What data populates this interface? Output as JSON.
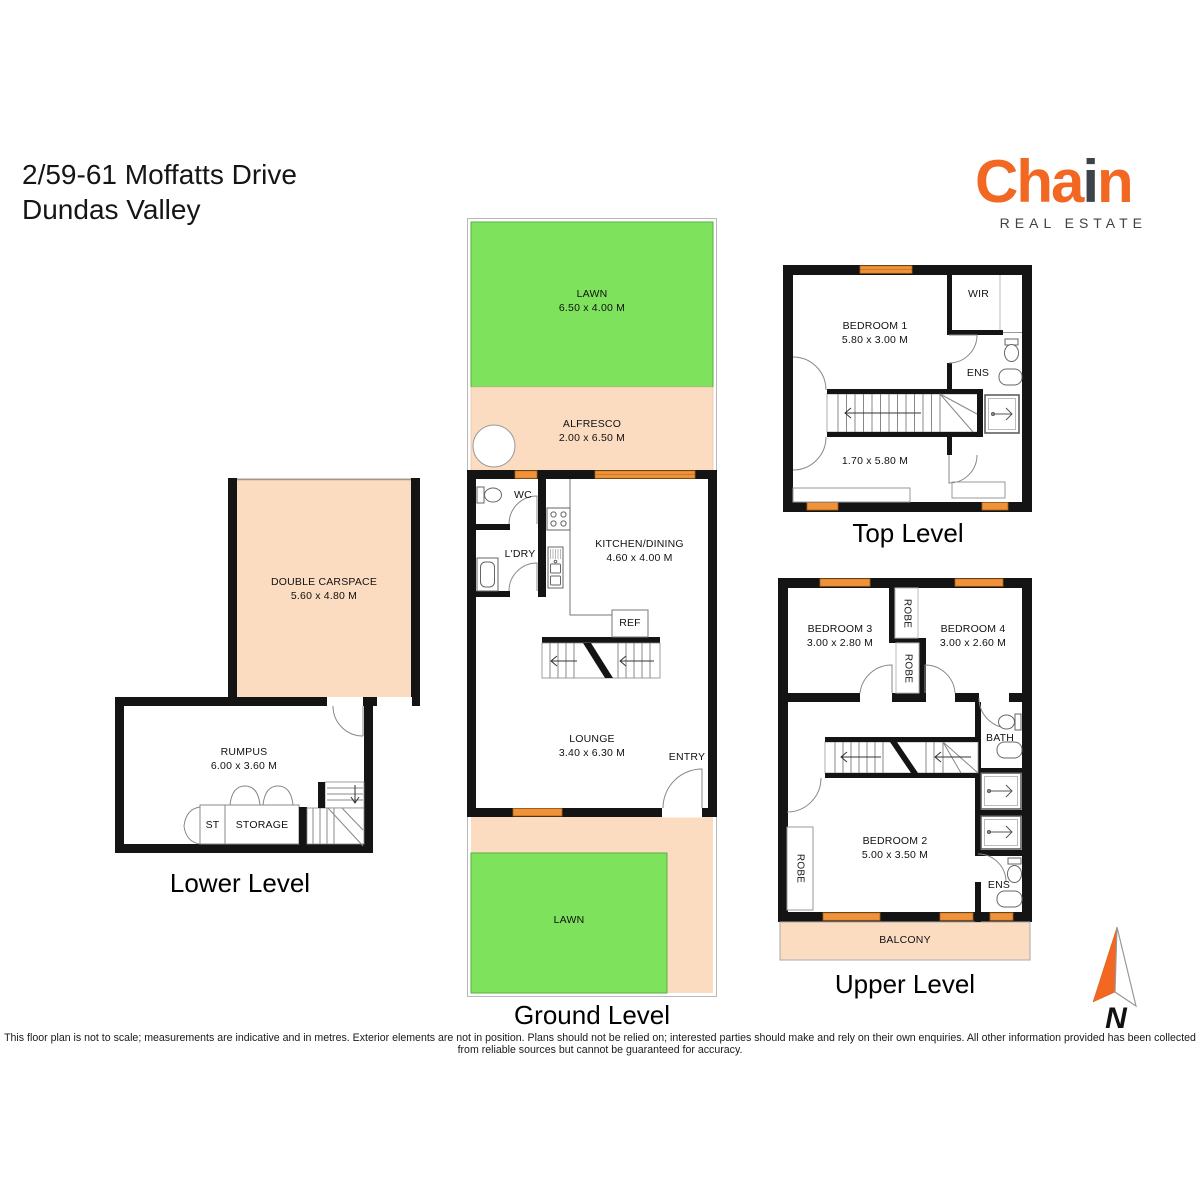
{
  "address": {
    "line1": "2/59-61 Moffatts Drive",
    "line2": "Dundas Valley"
  },
  "logo": {
    "word_part1": "Cha",
    "word_i": "i",
    "word_part2": "n",
    "tagline": "REAL ESTATE"
  },
  "ground": {
    "title": "Ground Level",
    "lawn_top": {
      "name": "LAWN",
      "dims": "6.50 x 4.00 M"
    },
    "alfresco": {
      "name": "ALFRESCO",
      "dims": "2.00 x 6.50 M"
    },
    "wc": "WC",
    "ldry": "L'DRY",
    "kitchen": {
      "name": "KITCHEN/DINING",
      "dims": "4.60 x 4.00 M"
    },
    "ref": "REF",
    "lounge": {
      "name": "LOUNGE",
      "dims": "3.40 x 6.30 M"
    },
    "entry": "ENTRY",
    "lawn_bottom": {
      "name": "LAWN"
    }
  },
  "lower": {
    "title": "Lower Level",
    "carspace": {
      "name": "DOUBLE CARSPACE",
      "dims": "5.60 x 4.80 M"
    },
    "rumpus": {
      "name": "RUMPUS",
      "dims": "6.00 x 3.60 M"
    },
    "st": "ST",
    "storage": "STORAGE"
  },
  "top": {
    "title": "Top Level",
    "bedroom1": {
      "name": "BEDROOM 1",
      "dims": "5.80 x 3.00 M"
    },
    "wir": "WIR",
    "ens": "ENS",
    "hall_dims": "1.70 x 5.80 M"
  },
  "upper": {
    "title": "Upper Level",
    "bedroom3": {
      "name": "BEDROOM 3",
      "dims": "3.00 x 2.80 M"
    },
    "bedroom4": {
      "name": "BEDROOM 4",
      "dims": "3.00 x 2.60 M"
    },
    "robe_a": "ROBE",
    "robe_b": "ROBE",
    "robe_c": "ROBE",
    "bath": "BATH",
    "bedroom2": {
      "name": "BEDROOM 2",
      "dims": "5.00 x 3.50 M"
    },
    "ens": "ENS",
    "balcony": "BALCONY"
  },
  "compass": {
    "north_label": "N"
  },
  "disclaimer": "This floor plan is not to scale; measurements are indicative and in metres. Exterior elements are not in position. Plans should not be relied on; interested parties should make and rely on their own enquiries. All other information provided has been collected from reliable sources but cannot be guaranteed for accuracy.",
  "colors": {
    "brand_orange": "#F26722",
    "brand_gray": "#3C434A",
    "lawn_green": "#7EE25C",
    "exterior_peach": "#FBDCC1",
    "window_orange": "#EF9239",
    "wall_black": "#141414"
  }
}
